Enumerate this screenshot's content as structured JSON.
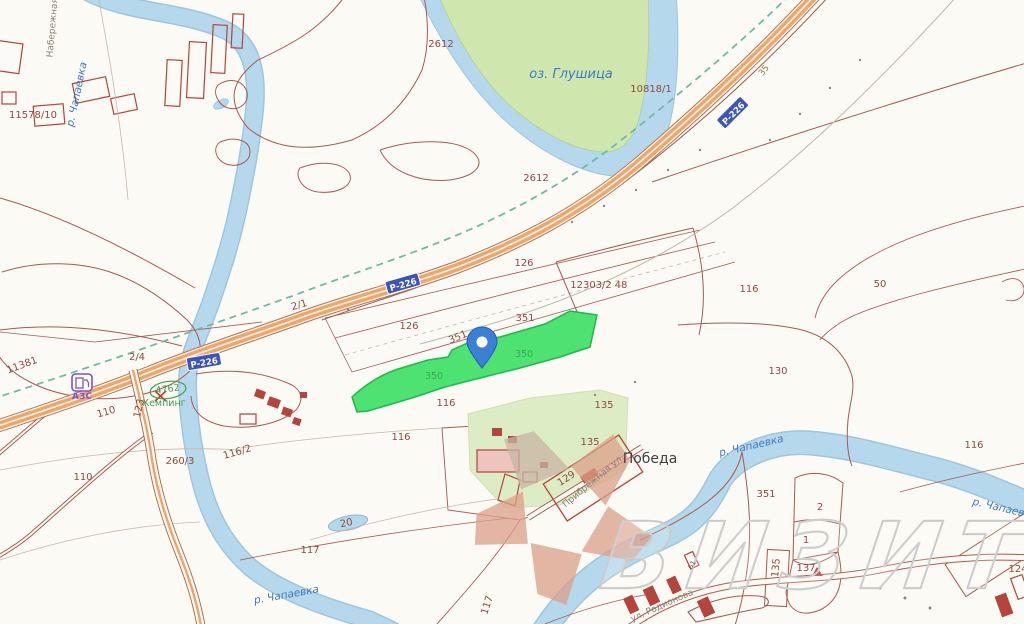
{
  "map": {
    "title": "cadastral-map-view",
    "watermark": {
      "text": "ВИЗИТ"
    },
    "colors": {
      "background": "#fcfaf5",
      "parcel-line": "#a85a50",
      "parcel-label": "#8f4a42",
      "building": "#b5443c",
      "building-fill": "#e9b9b1",
      "river": "#b5d8ec",
      "river-edge": "#9fc6de",
      "water-label": "#3f78c0",
      "lake-island": "#cfe7ae",
      "highway": "#f0a56a",
      "highway-edge": "#b86e48",
      "rail-dash": "#72b8a8",
      "selected-parcel": "#3fdf66",
      "selected-edge": "#1fb84c",
      "light-parcel": "#dcedc6",
      "shield": "#3d55b8",
      "pin": "#3b7fd6",
      "poi-purple": "#7b52c8",
      "camping-green": "#3f9f4f",
      "watermark": "#c9c9c9",
      "logo-salmon": "#dba088",
      "logo-gray": "#c9b4a4"
    },
    "pin": {
      "x": 482,
      "y": 368
    },
    "shields": [
      {
        "text": "Р-226",
        "x": 733,
        "y": 113,
        "rot": -45
      },
      {
        "text": "Р-226",
        "x": 403,
        "y": 284,
        "rot": -16
      },
      {
        "text": "Р-226",
        "x": 204,
        "y": 362,
        "rot": -10
      }
    ],
    "labels": [
      {
        "text": "Набережная",
        "x": 55,
        "y": 28,
        "rot": -85,
        "cls": "street"
      },
      {
        "text": "р. Чапаевка",
        "x": 80,
        "y": 95,
        "rot": -78,
        "cls": "water"
      },
      {
        "text": "11578/10",
        "x": 33,
        "y": 118,
        "rot": 0,
        "cls": "parcel"
      },
      {
        "text": "2612",
        "x": 441,
        "y": 47,
        "rot": 0,
        "cls": "parcel"
      },
      {
        "text": "оз. Глушица",
        "x": 571,
        "y": 78,
        "rot": 0,
        "cls": "water-lg"
      },
      {
        "text": "10818/1",
        "x": 651,
        "y": 92,
        "rot": 0,
        "cls": "parcel"
      },
      {
        "text": "35",
        "x": 766,
        "y": 72,
        "rot": -52,
        "cls": "km"
      },
      {
        "text": "2612",
        "x": 536,
        "y": 181,
        "rot": 0,
        "cls": "parcel"
      },
      {
        "text": "126",
        "x": 524,
        "y": 266,
        "rot": 0,
        "cls": "parcel"
      },
      {
        "text": "12303/2",
        "x": 591,
        "y": 288,
        "rot": 0,
        "cls": "parcel"
      },
      {
        "text": "48",
        "x": 621,
        "y": 288,
        "rot": 0,
        "cls": "parcel"
      },
      {
        "text": "116",
        "x": 749,
        "y": 292,
        "rot": 0,
        "cls": "parcel"
      },
      {
        "text": "50",
        "x": 880,
        "y": 287,
        "rot": 0,
        "cls": "parcel"
      },
      {
        "text": "2/1",
        "x": 300,
        "y": 308,
        "rot": -16,
        "cls": "parcel"
      },
      {
        "text": "126",
        "x": 409,
        "y": 329,
        "rot": 0,
        "cls": "parcel"
      },
      {
        "text": "351",
        "x": 525,
        "y": 321,
        "rot": 0,
        "cls": "parcel"
      },
      {
        "text": "351",
        "x": 459,
        "y": 340,
        "rot": -22,
        "cls": "parcel"
      },
      {
        "text": "350",
        "x": 524,
        "y": 357,
        "rot": 0,
        "cls": "sel"
      },
      {
        "text": "350",
        "x": 434,
        "y": 379,
        "rot": 0,
        "cls": "sel"
      },
      {
        "text": "2/4",
        "x": 137,
        "y": 360,
        "rot": 0,
        "cls": "parcel"
      },
      {
        "text": "11381",
        "x": 23,
        "y": 368,
        "rot": -20,
        "cls": "parcel"
      },
      {
        "text": "130",
        "x": 778,
        "y": 374,
        "rot": 0,
        "cls": "parcel"
      },
      {
        "text": "116",
        "x": 446,
        "y": 406,
        "rot": 0,
        "cls": "parcel"
      },
      {
        "text": "123",
        "x": 142,
        "y": 409,
        "rot": -78,
        "cls": "parcel"
      },
      {
        "text": "110",
        "x": 107,
        "y": 415,
        "rot": -16,
        "cls": "parcel"
      },
      {
        "text": "4762",
        "x": 168,
        "y": 392,
        "rot": -8,
        "cls": "green"
      },
      {
        "text": "Кемпинг",
        "x": 164,
        "y": 406,
        "rot": 0,
        "cls": "green"
      },
      {
        "text": "АЗС",
        "x": 82,
        "y": 399,
        "rot": 0,
        "cls": "poi"
      },
      {
        "text": "116",
        "x": 401,
        "y": 440,
        "rot": 0,
        "cls": "parcel"
      },
      {
        "text": "135",
        "x": 604,
        "y": 408,
        "rot": 0,
        "cls": "parcel"
      },
      {
        "text": "260/3",
        "x": 180,
        "y": 464,
        "rot": 0,
        "cls": "parcel"
      },
      {
        "text": "116/2",
        "x": 238,
        "y": 455,
        "rot": -16,
        "cls": "parcel"
      },
      {
        "text": "110",
        "x": 83,
        "y": 480,
        "rot": 0,
        "cls": "parcel"
      },
      {
        "text": "135",
        "x": 590,
        "y": 445,
        "rot": 0,
        "cls": "parcel"
      },
      {
        "text": "129",
        "x": 568,
        "y": 481,
        "rot": -33,
        "cls": "parcel"
      },
      {
        "text": "Победа",
        "x": 650,
        "y": 463,
        "rot": 0,
        "cls": "town"
      },
      {
        "text": "Прибрежная ул.",
        "x": 595,
        "y": 483,
        "rot": -40,
        "cls": "street"
      },
      {
        "text": "20",
        "x": 347,
        "y": 526,
        "rot": -12,
        "cls": "parcel"
      },
      {
        "text": "117",
        "x": 310,
        "y": 553,
        "rot": 0,
        "cls": "parcel"
      },
      {
        "text": "117",
        "x": 490,
        "y": 606,
        "rot": -72,
        "cls": "parcel"
      },
      {
        "text": "р. Чапаевка",
        "x": 287,
        "y": 598,
        "rot": -10,
        "cls": "water"
      },
      {
        "text": "р. Чапаевка",
        "x": 752,
        "y": 449,
        "rot": -13,
        "cls": "water"
      },
      {
        "text": "р. Чапаевка",
        "x": 1004,
        "y": 512,
        "rot": 13,
        "cls": "water"
      },
      {
        "text": "351",
        "x": 766,
        "y": 497,
        "rot": 0,
        "cls": "parcel"
      },
      {
        "text": "116",
        "x": 974,
        "y": 448,
        "rot": 0,
        "cls": "parcel"
      },
      {
        "text": "2",
        "x": 820,
        "y": 510,
        "rot": 0,
        "cls": "parcel"
      },
      {
        "text": "1",
        "x": 806,
        "y": 543,
        "rot": 0,
        "cls": "parcel"
      },
      {
        "text": "135",
        "x": 779,
        "y": 568,
        "rot": -85,
        "cls": "parcel"
      },
      {
        "text": "137",
        "x": 806,
        "y": 571,
        "rot": 0,
        "cls": "parcel"
      },
      {
        "text": "124",
        "x": 1018,
        "y": 572,
        "rot": 0,
        "cls": "parcel"
      },
      {
        "text": "61",
        "x": 694,
        "y": 566,
        "rot": -60,
        "cls": "house"
      },
      {
        "text": "ул. Родионова",
        "x": 663,
        "y": 608,
        "rot": -24,
        "cls": "street"
      }
    ]
  }
}
